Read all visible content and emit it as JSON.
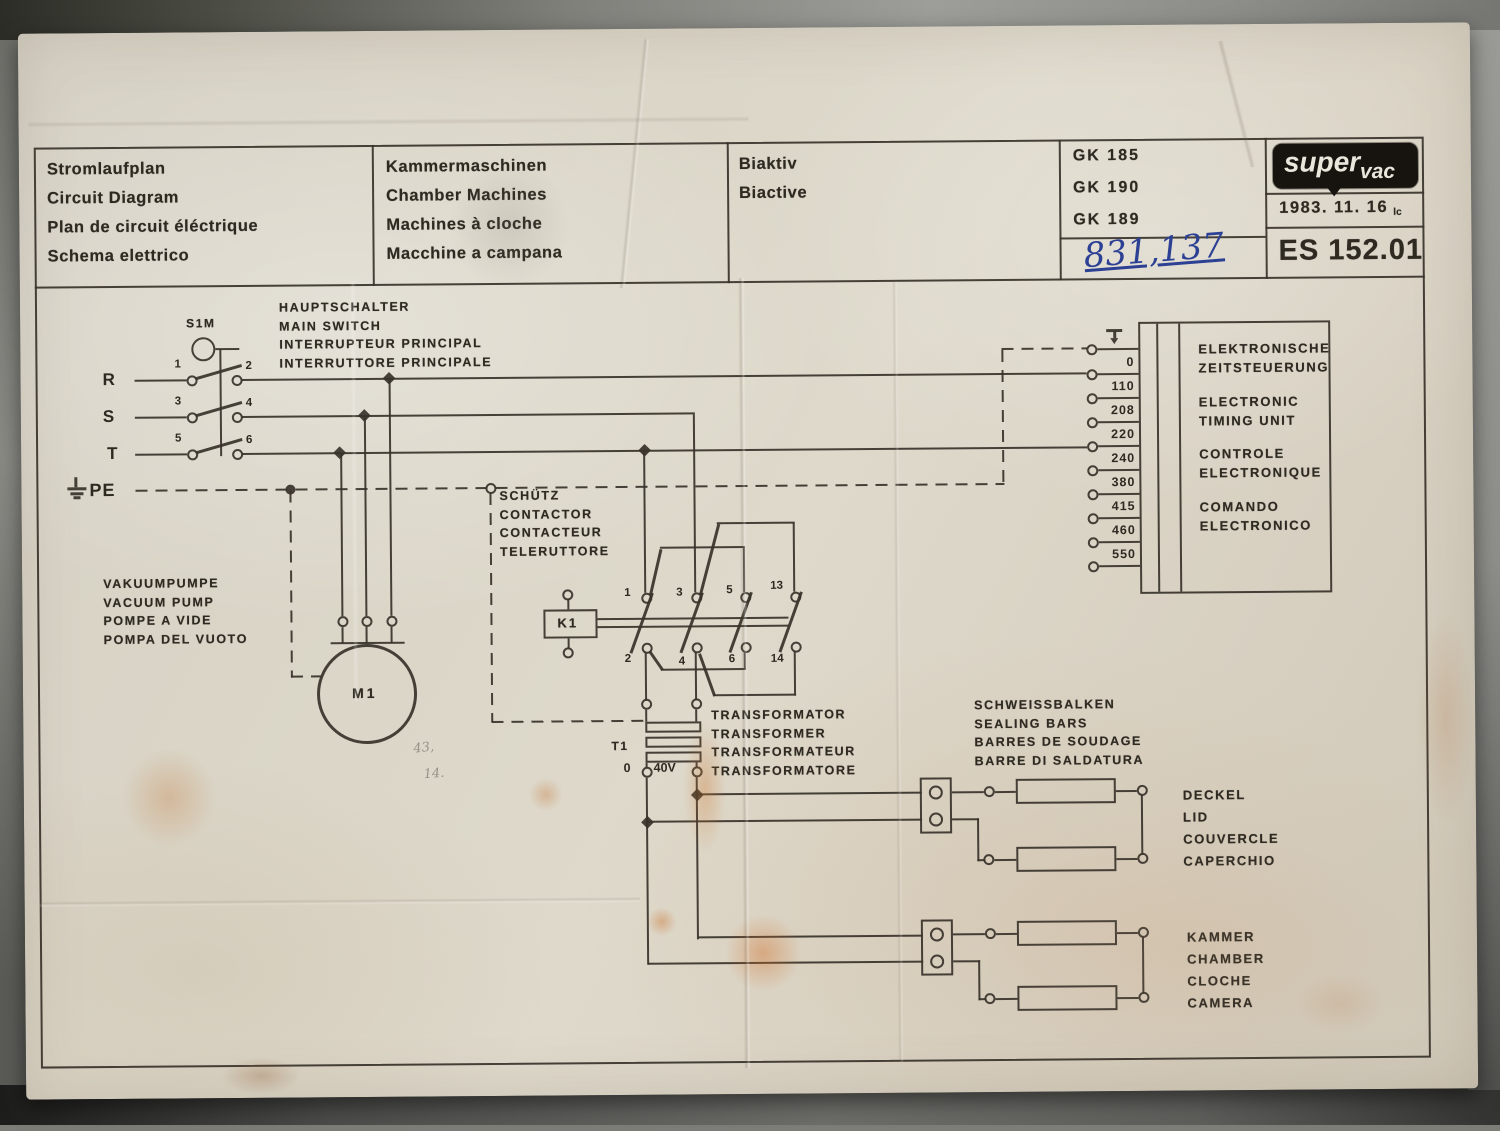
{
  "title_block": {
    "identification": "Stromlaufplan\nCircuit Diagram\nPlan de circuit éléctrique\nSchema elettrico",
    "machine_type": "Kammermaschinen\nChamber Machines\nMachines à cloche\nMacchine a campana",
    "variant": "Biaktiv\nBiactive",
    "models": [
      "GK 185",
      "GK 190",
      "GK 189"
    ],
    "handwritten_number": "831,137",
    "brand": {
      "logo_super": "super",
      "logo_vac": "vac"
    },
    "date": "1983. 11. 16",
    "date_initials": "lc",
    "drawing_number": "ES 152.01"
  },
  "labels": {
    "main_switch": "HAUPTSCHALTER\nMAIN SWITCH\nINTERRUPTEUR PRINCIPAL\nINTERRUTTORE PRINCIPALE",
    "contactor": "SCHÜTZ\nCONTACTOR\nCONTACTEUR\nTELERUTTORE",
    "vacuum_pump": "VAKUUMPUMPE\nVACUUM PUMP\nPOMPE A VIDE\nPOMPA DEL VUOTO",
    "transformer": "TRANSFORMATOR\nTRANSFORMER\nTRANSFORMATEUR\nTRANSFORMATORE",
    "sealing_bars": "SCHWEISSBALKEN\nSEALING BARS\nBARRES DE SOUDAGE\nBARRE DI SALDATURA",
    "lid": "DECKEL\nLID\nCOUVERCLE\nCAPERCHIO",
    "chamber": "KAMMER\nCHAMBER\nCLOCHE\nCAMERA",
    "timing_unit_de": "ELEKTRONISCHE\nZEITSTEUERUNG",
    "timing_unit_en": "ELECTRONIC\nTIMING UNIT",
    "timing_unit_fr": "CONTROLE\nELECTRONIQUE",
    "timing_unit_it": "COMANDO\nELECTRONICO"
  },
  "components": {
    "main_switch_id": "S1M",
    "phase_r": "R",
    "phase_s": "S",
    "phase_t": "T",
    "pe": "PE",
    "switch_contacts": [
      "1",
      "2",
      "3",
      "4",
      "5",
      "6"
    ],
    "contactor_id": "K1",
    "contactor_contacts_top": [
      "1",
      "3",
      "5",
      "13"
    ],
    "contactor_contacts_bottom": [
      "2",
      "4",
      "6",
      "14"
    ],
    "motor_id": "M1",
    "transformer_id": "T1",
    "transformer_secondary": [
      "0",
      "40V"
    ],
    "timing_taps": [
      "0",
      "110",
      "208",
      "220",
      "240",
      "380",
      "415",
      "460",
      "550"
    ]
  },
  "pencil_notes": [
    "43,",
    "14."
  ]
}
